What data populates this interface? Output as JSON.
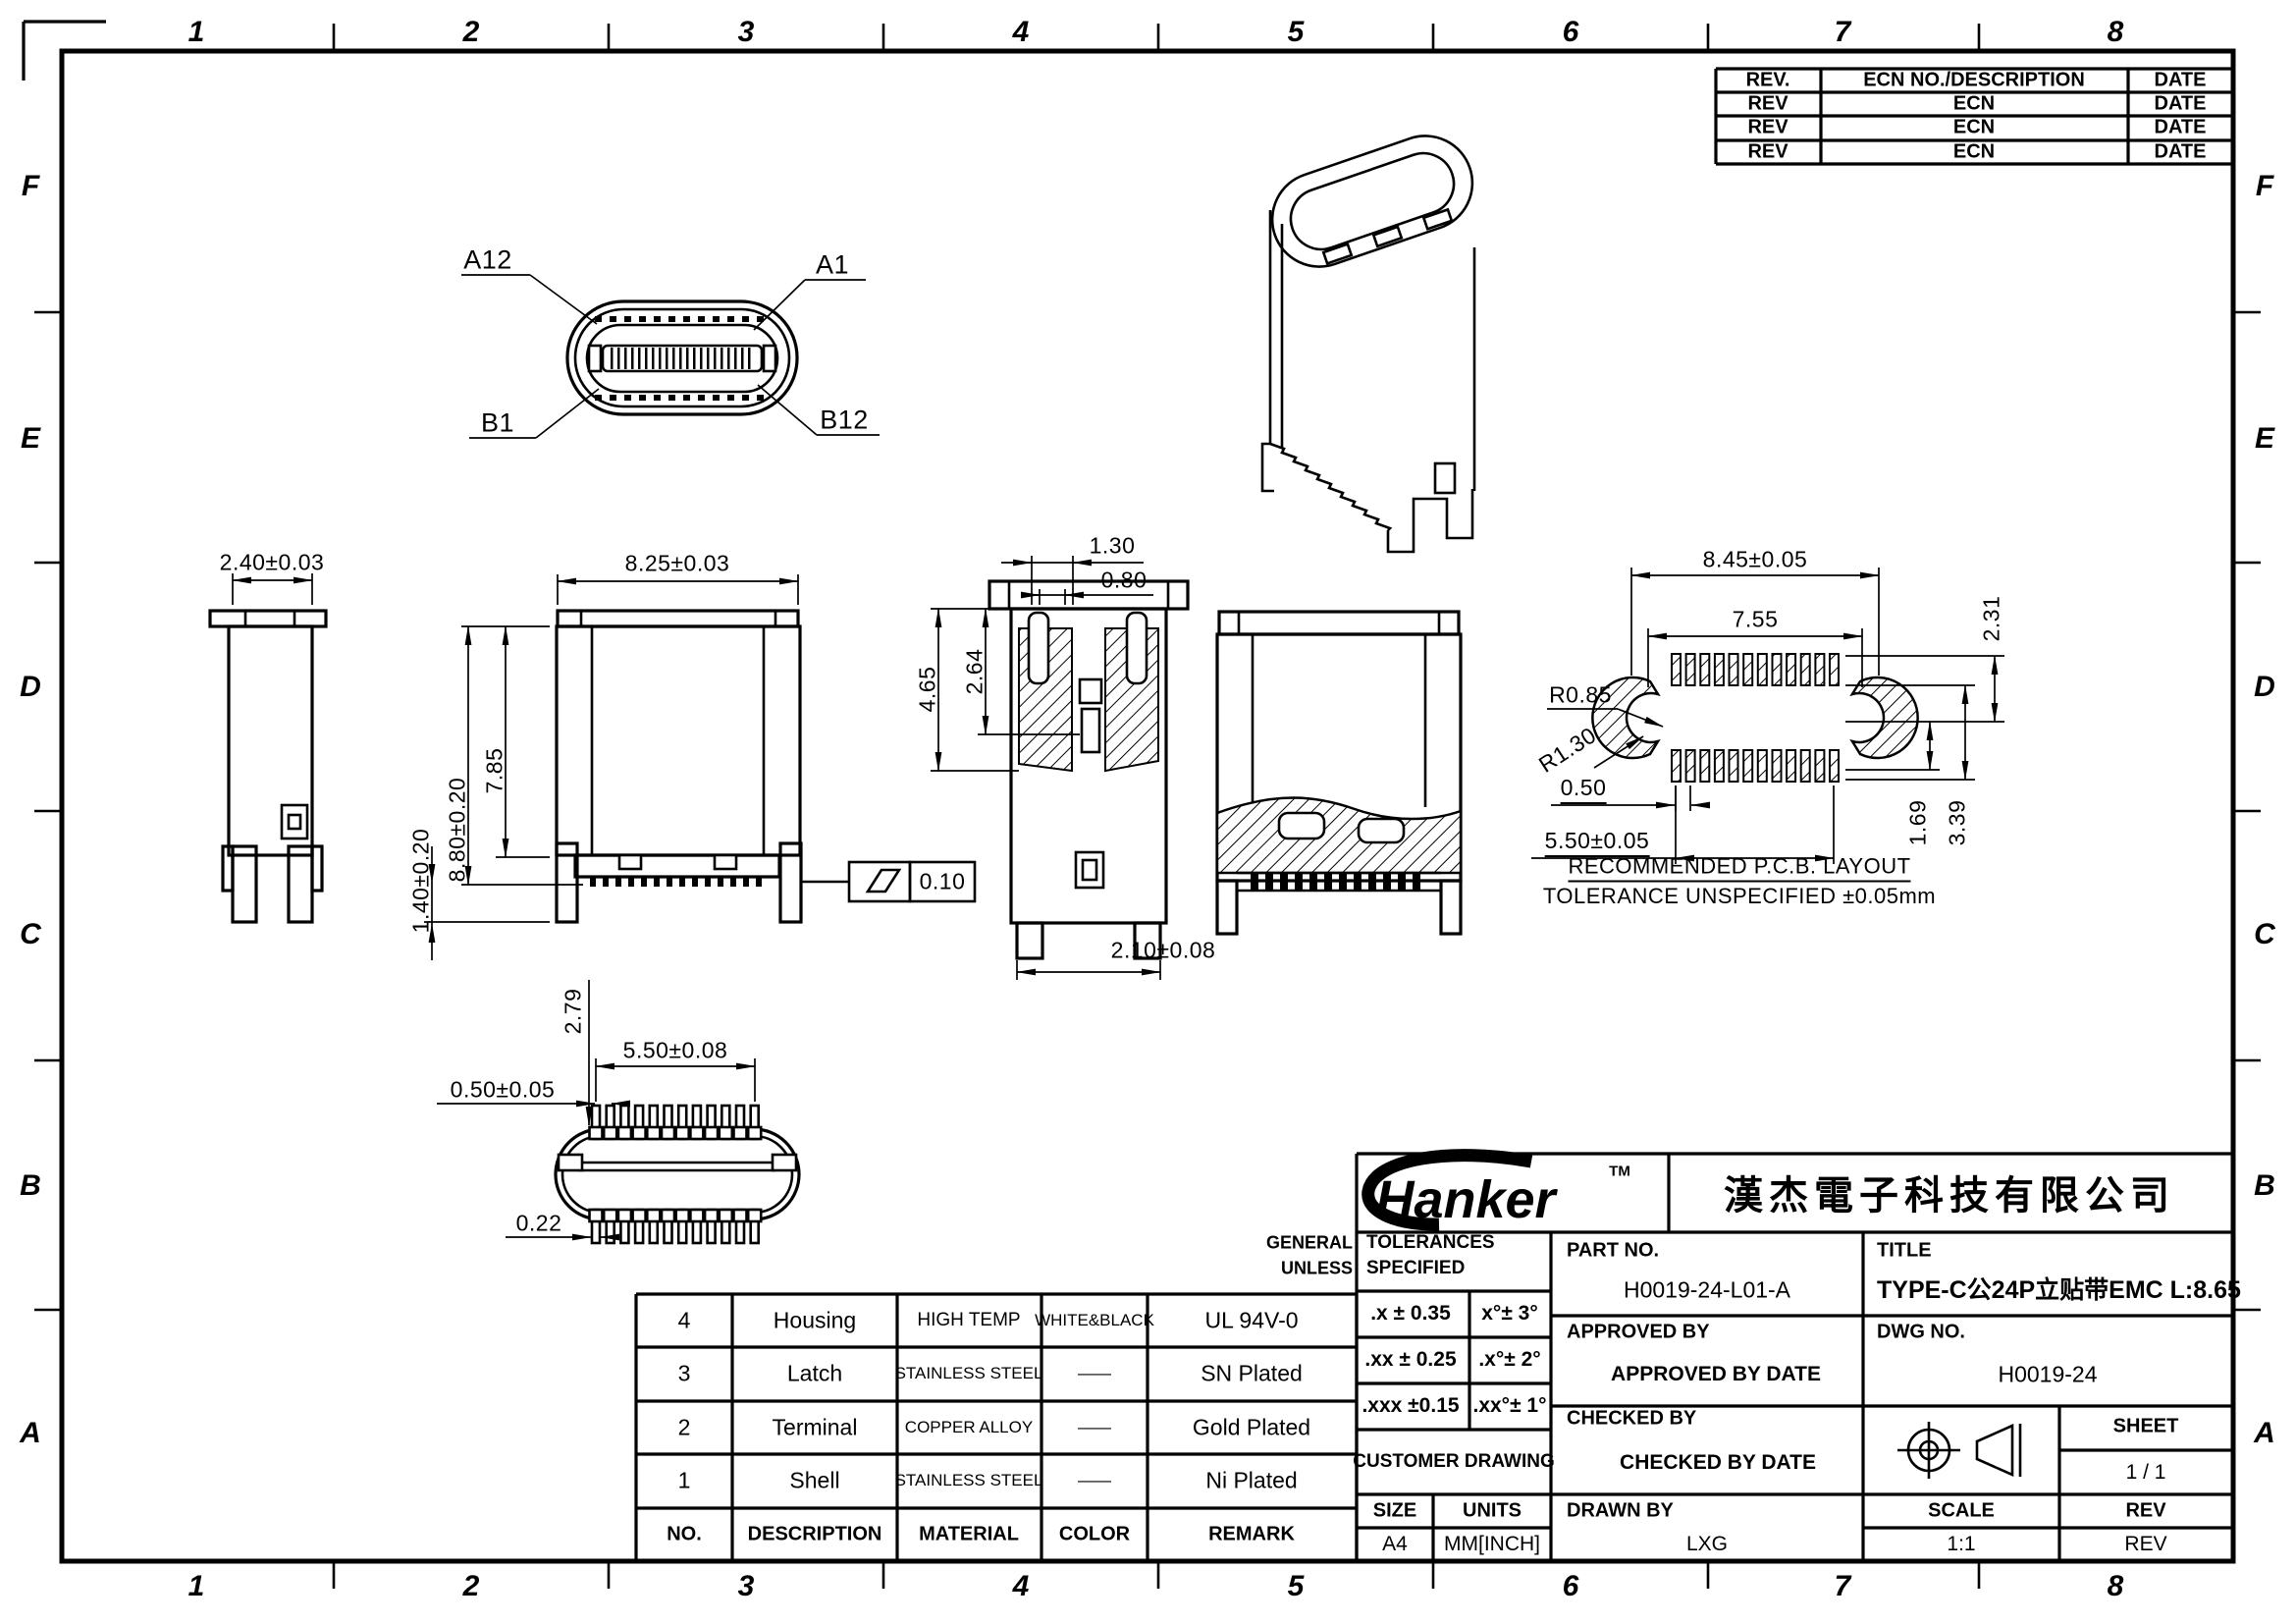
{
  "drawing": {
    "zones": {
      "rows": [
        "F",
        "E",
        "D",
        "C",
        "B",
        "A"
      ],
      "cols": [
        "1",
        "2",
        "3",
        "4",
        "5",
        "6",
        "7",
        "8"
      ]
    },
    "revision_table": {
      "header": {
        "rev": "REV.",
        "ecn": "ECN NO./DESCRIPTION",
        "date": "DATE"
      },
      "rows": [
        {
          "rev": "REV",
          "ecn": "ECN",
          "date": "DATE"
        },
        {
          "rev": "REV",
          "ecn": "ECN",
          "date": "DATE"
        },
        {
          "rev": "REV",
          "ecn": "ECN",
          "date": "DATE"
        }
      ]
    },
    "views": {
      "plug_face": {
        "a12": "A12",
        "a1": "A1",
        "b1": "B1",
        "b12": "B12"
      },
      "dims": {
        "side_width": "2.40±0.03",
        "front_width": "8.25±0.03",
        "body_height": "7.85",
        "overall_height": "8.80±0.20",
        "foot_height": "1.40±0.20",
        "slot_width": "1.30",
        "slot_inner": "0.80",
        "section_depth1": "4.65",
        "section_depth2": "2.64",
        "thickness": "2.10±0.08",
        "flatness": "0.10",
        "bottom_span": "5.50±0.08",
        "bottom_pitch": "0.50±0.05",
        "bottom_height": "2.79",
        "pin_width": "0.22"
      },
      "pcb": {
        "title": "RECOMMENDED   P.C.B.  LAYOUT",
        "note": "TOLERANCE  UNSPECIFIED  ±0.05mm",
        "dims": {
          "outer": "8.45±0.05",
          "inner": "7.55",
          "r_inner": "R0.85",
          "r_outer": "R1.30",
          "pitch": "0.50",
          "span": "5.50±0.05",
          "v1": "2.31",
          "v2": "1.69",
          "v3": "3.39"
        }
      }
    },
    "bom": {
      "rows": [
        {
          "no": "4",
          "description": "Housing",
          "material": "HIGH TEMP",
          "color": "WHITE&BLACK",
          "remark": "UL 94V-0"
        },
        {
          "no": "3",
          "description": "Latch",
          "material": "STAINLESS STEEL",
          "color": "——",
          "remark": "SN Plated"
        },
        {
          "no": "2",
          "description": "Terminal",
          "material": "COPPER ALLOY",
          "color": "——",
          "remark": "Gold Plated"
        },
        {
          "no": "1",
          "description": "Shell",
          "material": "STAINLESS STEEL",
          "color": "——",
          "remark": "Ni Plated"
        },
        {
          "no": "NO.",
          "description": "DESCRIPTION",
          "material": "MATERIAL",
          "color": "COLOR",
          "remark": "REMARK"
        }
      ]
    },
    "title_block": {
      "logo_text": "Hanker",
      "logo_tm": "TM",
      "company": "漢杰電子科技有限公司",
      "general_1": "GENERAL",
      "general_2": "UNLESS",
      "tol_header_1": "TOLERANCES",
      "tol_header_2": "SPECIFIED",
      "tol_rows": [
        {
          "lin": ".x ± 0.35",
          "ang": "x°±  3°"
        },
        {
          "lin": ".xx ± 0.25",
          "ang": ".x°±  2°"
        },
        {
          "lin": ".xxx ±0.15",
          "ang": ".xx°±  1°"
        }
      ],
      "customer_drawing": "CUSTOMER  DRAWING",
      "part_no_label": "PART  NO.",
      "part_no": "H0019-24-L01-A",
      "title_label": "TITLE",
      "title": "TYPE-C公24P立贴带EMC L:8.65",
      "approved_by": "APPROVED  BY",
      "approved_by_date": "APPROVED BY DATE",
      "dwg_no_label": "DWG  NO.",
      "dwg_no": "H0019-24",
      "checked_by": "CHECKED  BY",
      "checked_by_date": "CHECKED BY DATE",
      "sheet_label": "SHEET",
      "sheet": "1 / 1",
      "size_label": "SIZE",
      "size": "A4",
      "units_label": "UNITS",
      "units": "MM[INCH]",
      "drawn_by_label": "DRAWN  BY",
      "drawn_by": "LXG",
      "scale_label": "SCALE",
      "scale": "1:1",
      "rev_label": "REV",
      "rev": "REV"
    }
  }
}
